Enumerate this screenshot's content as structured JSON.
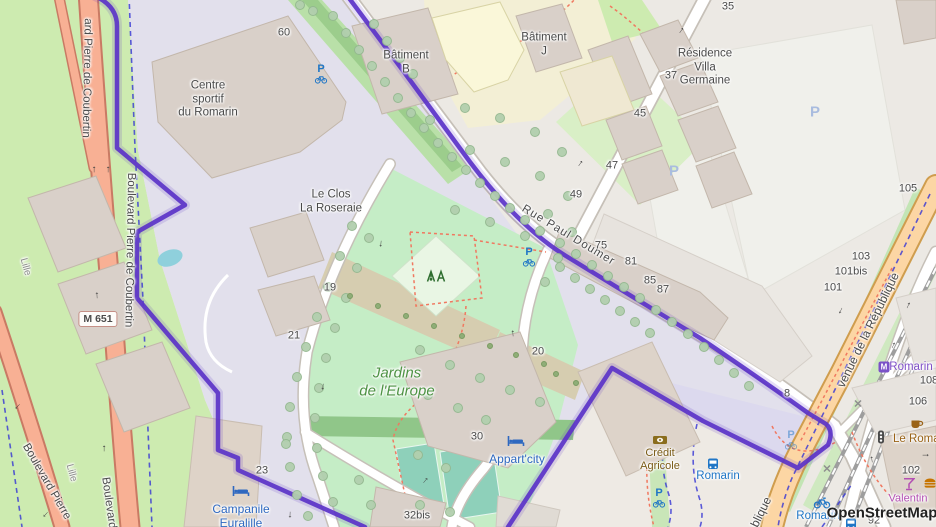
{
  "attribution": {
    "text": "OpenStreetMap"
  },
  "map": {
    "colors": {
      "base": "#ece9e4",
      "grass": "#cdebb0",
      "residential_lavender": "#e2e0ec",
      "parcel_lavender": "#dcd9ee",
      "park": "#c5edc6",
      "parking": "#f0f0eb",
      "building": "#d9d0c9",
      "building_stroke": "#c3b7ab",
      "water": "#8fd0dc",
      "trunk_road": "#f8b094",
      "primary_road": "#fcd6a4",
      "boundary": "#5b33c8",
      "cycleway": "#3434d4",
      "footpath": "#f07860",
      "tree": "#b2cfae",
      "tree_stroke": "#94b890",
      "poi_blue": "#2e68c0",
      "poi_brown": "#9a6317",
      "bank_brown": "#8a6d1d",
      "transit_purple": "#7b52c8",
      "poi_magenta": "#b34fb3",
      "transit_blue": "#2076c6"
    },
    "icon_text": {
      "parking": "P",
      "metro": "M"
    },
    "road_ref": {
      "t": "M 651",
      "x": 98,
      "y": 319
    },
    "road_labels": [
      {
        "t": "Rue Paul Doumer",
        "x": 568,
        "y": 236,
        "r": 31,
        "s": 11.5,
        "ls": 1
      },
      {
        "t": "venue de la République",
        "x": 868,
        "y": 330,
        "r": -64,
        "s": 12
      },
      {
        "t": "blique",
        "x": 761,
        "y": 512,
        "r": -64,
        "s": 12
      },
      {
        "t": "ard Pierre de Coubertin",
        "x": 86,
        "y": 78,
        "r": 91,
        "s": 11.5
      },
      {
        "t": "Boulevard Pierre de Coubertin",
        "x": 129,
        "y": 250,
        "r": 91,
        "s": 11.5
      },
      {
        "t": "Boulevard Pierre",
        "x": 46,
        "y": 482,
        "r": 60,
        "s": 11.5
      },
      {
        "t": "Boulevard",
        "x": 108,
        "y": 503,
        "r": 82,
        "s": 11.5
      },
      {
        "t": "Lille",
        "x": 25,
        "y": 267,
        "r": 75,
        "s": 10,
        "c": "#8a8a8a"
      },
      {
        "t": "Lille",
        "x": 71,
        "y": 473,
        "r": 75,
        "s": 10,
        "c": "#8a8a8a"
      }
    ],
    "place_labels": [
      {
        "lines": [
          "Centre",
          "sportif",
          "du Romarin"
        ],
        "x": 208,
        "y": 100,
        "s": 11.5
      },
      {
        "lines": [
          "Le Clos",
          "La Roseraie"
        ],
        "x": 331,
        "y": 202,
        "s": 11.5
      },
      {
        "lines": [
          "Bâtiment",
          "B"
        ],
        "x": 406,
        "y": 63,
        "s": 11.5
      },
      {
        "lines": [
          "Bâtiment",
          "J"
        ],
        "x": 544,
        "y": 45,
        "s": 11.5
      },
      {
        "lines": [
          "Résidence",
          "Villa",
          "Germaine"
        ],
        "x": 705,
        "y": 68,
        "s": 11.5
      },
      {
        "lines": [
          "Jardins",
          "de l'Europe"
        ],
        "x": 397,
        "y": 382,
        "s": 15,
        "c": "#4d9243",
        "italic": true
      }
    ],
    "poi_labels": [
      {
        "lines": [
          "Appart'city"
        ],
        "x": 517,
        "y": 459,
        "s": 12,
        "c": "#2e68c0"
      },
      {
        "lines": [
          "Crédit",
          "Agricole"
        ],
        "x": 660,
        "y": 460,
        "s": 11,
        "c": "#7a5b16"
      },
      {
        "lines": [
          "Campanile",
          "Euralille"
        ],
        "x": 241,
        "y": 516,
        "s": 12,
        "c": "#2e68c0"
      },
      {
        "lines": [
          "Romarin"
        ],
        "x": 911,
        "y": 368,
        "s": 11.5,
        "c": "#8050c8"
      },
      {
        "lines": [
          "Romarin"
        ],
        "x": 718,
        "y": 477,
        "s": 11.5,
        "c": "#2076c6"
      },
      {
        "lines": [
          "Romarin"
        ],
        "x": 818,
        "y": 517,
        "s": 11.5,
        "c": "#2076c6"
      },
      {
        "lines": [
          "Le Romar"
        ],
        "x": 893,
        "y": 440,
        "s": 11.5,
        "c": "#9a6317",
        "anchor": "left"
      },
      {
        "lines": [
          "Valentin"
        ],
        "x": 908,
        "y": 499,
        "s": 11,
        "c": "#b34fb3"
      }
    ],
    "house_numbers": [
      {
        "t": "60",
        "x": 284,
        "y": 33
      },
      {
        "t": "35",
        "x": 728,
        "y": 7
      },
      {
        "t": "37",
        "x": 671,
        "y": 76
      },
      {
        "t": "45",
        "x": 640,
        "y": 114
      },
      {
        "t": "47",
        "x": 612,
        "y": 166
      },
      {
        "t": "49",
        "x": 576,
        "y": 195
      },
      {
        "t": "75",
        "x": 601,
        "y": 246
      },
      {
        "t": "81",
        "x": 631,
        "y": 262
      },
      {
        "t": "85",
        "x": 650,
        "y": 281
      },
      {
        "t": "87",
        "x": 663,
        "y": 290
      },
      {
        "t": "105",
        "x": 908,
        "y": 189
      },
      {
        "t": "103",
        "x": 861,
        "y": 257
      },
      {
        "t": "101bis",
        "x": 851,
        "y": 272
      },
      {
        "t": "101",
        "x": 833,
        "y": 288
      },
      {
        "t": "108",
        "x": 929,
        "y": 381
      },
      {
        "t": "106",
        "x": 918,
        "y": 402
      },
      {
        "t": "102",
        "x": 911,
        "y": 471
      },
      {
        "t": "92",
        "x": 874,
        "y": 521
      },
      {
        "t": "19",
        "x": 330,
        "y": 288
      },
      {
        "t": "21",
        "x": 294,
        "y": 336
      },
      {
        "t": "23",
        "x": 262,
        "y": 471
      },
      {
        "t": "20",
        "x": 538,
        "y": 352
      },
      {
        "t": "30",
        "x": 477,
        "y": 437
      },
      {
        "t": "32bis",
        "x": 417,
        "y": 516
      },
      {
        "t": "8",
        "x": 787,
        "y": 394
      }
    ],
    "icons": [
      {
        "type": "parking",
        "x": 815,
        "y": 112
      },
      {
        "type": "parking",
        "x": 674,
        "y": 171
      },
      {
        "type": "bicycle-parking",
        "x": 321,
        "y": 74
      },
      {
        "type": "bicycle-parking",
        "x": 529,
        "y": 257
      },
      {
        "type": "bicycle-parking",
        "x": 791,
        "y": 440,
        "faded": true
      },
      {
        "type": "bicycle-parking",
        "x": 659,
        "y": 498
      },
      {
        "type": "hotel",
        "x": 516,
        "y": 441
      },
      {
        "type": "hotel",
        "x": 241,
        "y": 491
      },
      {
        "type": "bank",
        "x": 660,
        "y": 440
      },
      {
        "type": "cafe",
        "x": 917,
        "y": 424
      },
      {
        "type": "bar",
        "x": 909,
        "y": 484
      },
      {
        "type": "fast-food",
        "x": 930,
        "y": 483
      },
      {
        "type": "bus-stop",
        "x": 713,
        "y": 464
      },
      {
        "type": "bus-stop",
        "x": 851,
        "y": 524
      },
      {
        "type": "metro",
        "x": 884,
        "y": 367
      },
      {
        "type": "bike-share",
        "x": 822,
        "y": 503
      },
      {
        "type": "traffic-light",
        "x": 881,
        "y": 437
      },
      {
        "type": "level-crossing",
        "x": 827,
        "y": 470
      },
      {
        "type": "level-crossing",
        "x": 858,
        "y": 405
      },
      {
        "type": "playground",
        "x": 436,
        "y": 276
      }
    ],
    "arrows": [
      {
        "x": 94,
        "y": 170,
        "r": 0
      },
      {
        "x": 108,
        "y": 170,
        "r": 0
      },
      {
        "x": 97,
        "y": 296,
        "r": 357
      },
      {
        "x": 104,
        "y": 449,
        "r": 0
      },
      {
        "x": 18,
        "y": 406,
        "r": 222
      },
      {
        "x": 46,
        "y": 514,
        "r": 222
      },
      {
        "x": 681,
        "y": 31,
        "r": 35
      },
      {
        "x": 580,
        "y": 164,
        "r": 35
      },
      {
        "x": 381,
        "y": 243,
        "r": 185
      },
      {
        "x": 323,
        "y": 386,
        "r": 188
      },
      {
        "x": 290,
        "y": 514,
        "r": 182
      },
      {
        "x": 513,
        "y": 334,
        "r": 355
      },
      {
        "x": 425,
        "y": 481,
        "r": 40
      },
      {
        "x": 908,
        "y": 306,
        "r": 25
      },
      {
        "x": 893,
        "y": 346,
        "r": 25
      },
      {
        "x": 841,
        "y": 310,
        "r": 205
      },
      {
        "x": 872,
        "y": 460,
        "r": 352
      },
      {
        "x": 925,
        "y": 455,
        "r": 90
      }
    ],
    "trees": [
      [
        333,
        16
      ],
      [
        346,
        33
      ],
      [
        359,
        50
      ],
      [
        372,
        66
      ],
      [
        385,
        82
      ],
      [
        398,
        98
      ],
      [
        411,
        113
      ],
      [
        424,
        128
      ],
      [
        438,
        143
      ],
      [
        452,
        157
      ],
      [
        466,
        170
      ],
      [
        480,
        183
      ],
      [
        495,
        196
      ],
      [
        510,
        208
      ],
      [
        525,
        220
      ],
      [
        540,
        231
      ],
      [
        374,
        24
      ],
      [
        387,
        41
      ],
      [
        400,
        58
      ],
      [
        413,
        74
      ],
      [
        300,
        5
      ],
      [
        313,
        11
      ],
      [
        560,
        243
      ],
      [
        576,
        254
      ],
      [
        592,
        265
      ],
      [
        608,
        276
      ],
      [
        624,
        287
      ],
      [
        640,
        298
      ],
      [
        656,
        310
      ],
      [
        672,
        322
      ],
      [
        688,
        334
      ],
      [
        704,
        347
      ],
      [
        719,
        360
      ],
      [
        734,
        373
      ],
      [
        749,
        386
      ],
      [
        560,
        267
      ],
      [
        575,
        278
      ],
      [
        590,
        289
      ],
      [
        605,
        300
      ],
      [
        620,
        311
      ],
      [
        635,
        322
      ],
      [
        650,
        333
      ],
      [
        352,
        226
      ],
      [
        340,
        256
      ],
      [
        328,
        287
      ],
      [
        317,
        317
      ],
      [
        306,
        347
      ],
      [
        297,
        377
      ],
      [
        290,
        407
      ],
      [
        287,
        437
      ],
      [
        290,
        467
      ],
      [
        297,
        495
      ],
      [
        308,
        516
      ],
      [
        369,
        238
      ],
      [
        357,
        268
      ],
      [
        346,
        298
      ],
      [
        335,
        328
      ],
      [
        326,
        358
      ],
      [
        319,
        388
      ],
      [
        315,
        418
      ],
      [
        317,
        448
      ],
      [
        323,
        476
      ],
      [
        333,
        502
      ],
      [
        430,
        120
      ],
      [
        465,
        108
      ],
      [
        500,
        118
      ],
      [
        535,
        132
      ],
      [
        562,
        152
      ],
      [
        470,
        150
      ],
      [
        505,
        162
      ],
      [
        540,
        176
      ],
      [
        568,
        196
      ],
      [
        455,
        210
      ],
      [
        490,
        222
      ],
      [
        525,
        236
      ],
      [
        548,
        214
      ],
      [
        572,
        232
      ],
      [
        558,
        258
      ],
      [
        545,
        282
      ],
      [
        420,
        350
      ],
      [
        450,
        365
      ],
      [
        480,
        378
      ],
      [
        510,
        390
      ],
      [
        540,
        402
      ],
      [
        428,
        395
      ],
      [
        458,
        408
      ],
      [
        486,
        420
      ],
      [
        418,
        455
      ],
      [
        446,
        468
      ],
      [
        420,
        505
      ],
      [
        450,
        512
      ],
      [
        359,
        480
      ],
      [
        371,
        505
      ],
      [
        286,
        444
      ]
    ],
    "shrubs": [
      [
        350,
        296
      ],
      [
        378,
        306
      ],
      [
        406,
        316
      ],
      [
        434,
        326
      ],
      [
        462,
        336
      ],
      [
        490,
        346
      ],
      [
        516,
        355
      ],
      [
        544,
        364
      ],
      [
        556,
        374
      ],
      [
        576,
        383
      ]
    ]
  }
}
